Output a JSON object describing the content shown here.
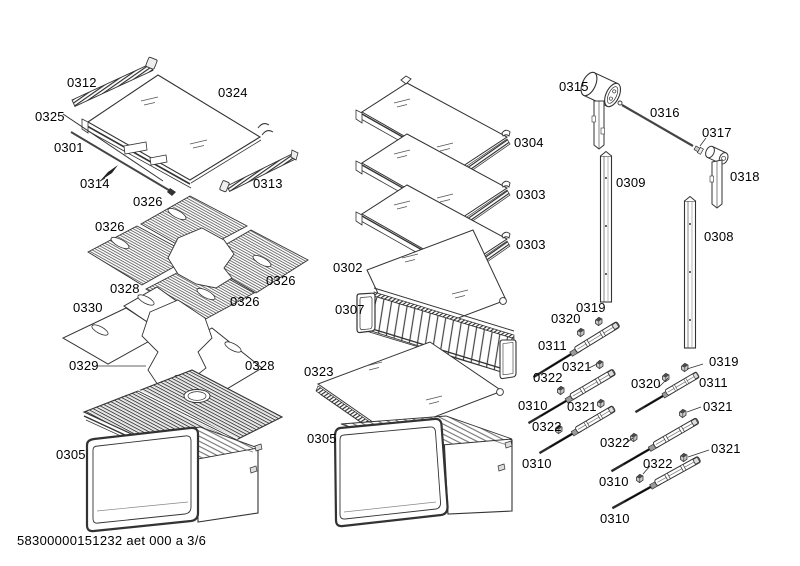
{
  "diagram": {
    "title": "appliance-exploded-parts-diagram",
    "footer_text": "58300000151232 aet 000 a 3/6",
    "page_indicator": "3/6",
    "line_color": "#333333",
    "labels": [
      {
        "text": "0312",
        "x": 67,
        "y": 76
      },
      {
        "text": "0324",
        "x": 218,
        "y": 86
      },
      {
        "text": "0325",
        "x": 35,
        "y": 110
      },
      {
        "text": "0301",
        "x": 54,
        "y": 141
      },
      {
        "text": "0314",
        "x": 80,
        "y": 177
      },
      {
        "text": "0313",
        "x": 253,
        "y": 177
      },
      {
        "text": "0326",
        "x": 133,
        "y": 195
      },
      {
        "text": "0326",
        "x": 95,
        "y": 220
      },
      {
        "text": "0326",
        "x": 266,
        "y": 274
      },
      {
        "text": "0326",
        "x": 230,
        "y": 295
      },
      {
        "text": "0328",
        "x": 110,
        "y": 282
      },
      {
        "text": "0330",
        "x": 73,
        "y": 301
      },
      {
        "text": "0329",
        "x": 69,
        "y": 359
      },
      {
        "text": "0328",
        "x": 245,
        "y": 359
      },
      {
        "text": "0305",
        "x": 56,
        "y": 448
      },
      {
        "text": "0304",
        "x": 514,
        "y": 136
      },
      {
        "text": "0303",
        "x": 516,
        "y": 188
      },
      {
        "text": "0303",
        "x": 516,
        "y": 238
      },
      {
        "text": "0302",
        "x": 333,
        "y": 261
      },
      {
        "text": "0307",
        "x": 335,
        "y": 303
      },
      {
        "text": "0323",
        "x": 304,
        "y": 365
      },
      {
        "text": "0305",
        "x": 307,
        "y": 432
      },
      {
        "text": "0315",
        "x": 559,
        "y": 80
      },
      {
        "text": "0316",
        "x": 650,
        "y": 106
      },
      {
        "text": "0317",
        "x": 702,
        "y": 126
      },
      {
        "text": "0318",
        "x": 730,
        "y": 170
      },
      {
        "text": "0309",
        "x": 616,
        "y": 176
      },
      {
        "text": "0308",
        "x": 704,
        "y": 230
      },
      {
        "text": "0319",
        "x": 576,
        "y": 301
      },
      {
        "text": "0320",
        "x": 551,
        "y": 312
      },
      {
        "text": "0311",
        "x": 538,
        "y": 339
      },
      {
        "text": "0321",
        "x": 562,
        "y": 360
      },
      {
        "text": "0322",
        "x": 533,
        "y": 371
      },
      {
        "text": "0310",
        "x": 518,
        "y": 399
      },
      {
        "text": "0321",
        "x": 567,
        "y": 400
      },
      {
        "text": "0322",
        "x": 532,
        "y": 420
      },
      {
        "text": "0310",
        "x": 522,
        "y": 457
      },
      {
        "text": "0319",
        "x": 709,
        "y": 355
      },
      {
        "text": "0320",
        "x": 631,
        "y": 377
      },
      {
        "text": "0311",
        "x": 699,
        "y": 376
      },
      {
        "text": "0321",
        "x": 703,
        "y": 400
      },
      {
        "text": "0322",
        "x": 600,
        "y": 436
      },
      {
        "text": "0321",
        "x": 711,
        "y": 442
      },
      {
        "text": "0322",
        "x": 643,
        "y": 457
      },
      {
        "text": "0310",
        "x": 599,
        "y": 475
      },
      {
        "text": "0310",
        "x": 600,
        "y": 512
      }
    ]
  }
}
